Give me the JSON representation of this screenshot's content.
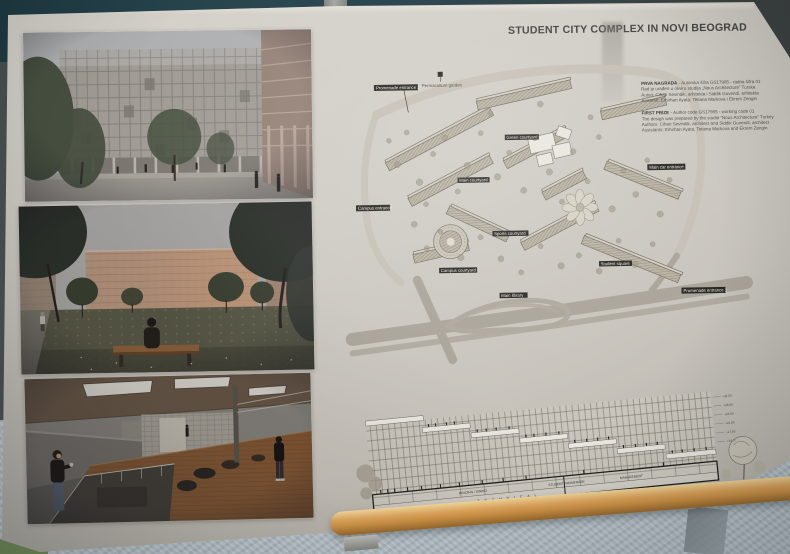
{
  "scene": {
    "setting": "competition poster board standing on a wooden easel over carpet",
    "colors": {
      "board": "#cdc9c1",
      "background_top": "#2a4550",
      "carpet": "#b2bdc3",
      "easel_wood": "#d39f58"
    }
  },
  "poster": {
    "title": "STUDENT CITY COMPLEX IN NOVI BEOGRAD",
    "award_sr": {
      "lead": "PRVA NAGRADA",
      "line1": "- Autorska šifra GS17985 - radna šifra 01",
      "line2": "Rad je urađen u okviru studija „Nous Architecture” Turska",
      "line3": "Autori: Cihan Sevindik, arhitekta i Siddik Guvendi, arhitekta",
      "line4": "Asistenti: Emirhan Ayata, Tetiana Markova i Ekrem Zengin"
    },
    "award_en": {
      "lead": "FIRST PRIZE",
      "line1": "- Author code GS17985 - working code 01",
      "line2": "The design was prepared by the studio “Nous Architecture” Turkey",
      "line3": "Authors: Cihan Sevindik, architect and Siddik Guvendi, architect",
      "line4": "Assistants: Emirhan Ayata, Tetiana Markova and Ekrem Zengin"
    },
    "site_plan": {
      "labels": [
        {
          "text": "Promenade entrance 2"
        },
        {
          "text": "Permaculture garden"
        },
        {
          "text": "Campus entrance"
        },
        {
          "text": "Main car entrance"
        },
        {
          "text": "Promenade entrance 1"
        },
        {
          "text": "Main courtyard"
        },
        {
          "text": "Sports courtyard"
        },
        {
          "text": "Campus courtyard"
        },
        {
          "text": "Green courtyard"
        },
        {
          "text": "Main library"
        },
        {
          "text": "Student square"
        }
      ]
    },
    "section": {
      "labels": {
        "reading": "READING / DINING",
        "promenade": "STUDENT PROMENADE",
        "management": "MANAGEMENT",
        "technical": "TECHNICAL"
      },
      "elevations": [
        "+31.50",
        "+28.00",
        "+24.50",
        "+21.00",
        "+17.50",
        "+14.00"
      ]
    }
  }
}
